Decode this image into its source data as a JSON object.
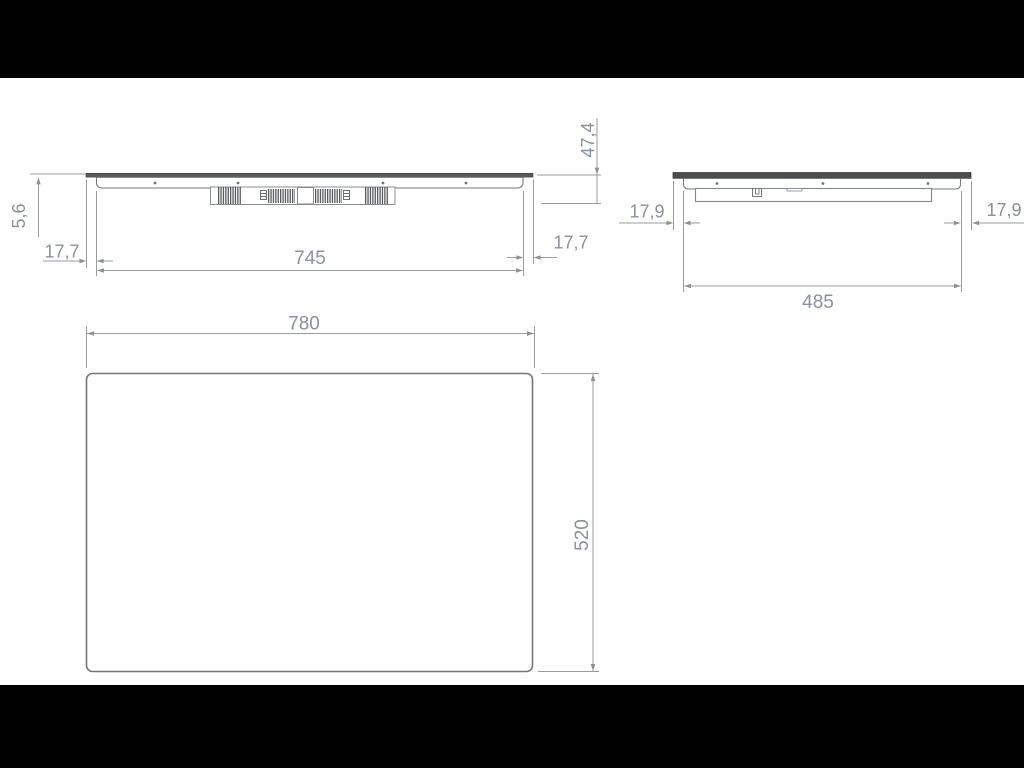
{
  "drawing_type": "appliance-dimension-drawing",
  "front_view": {
    "glass_protrusion": "5,6",
    "left_inset": "17,7",
    "body_width": "745",
    "right_inset": "17,7",
    "total_height": "47,4"
  },
  "side_view": {
    "left_inset": "17,9",
    "body_depth": "485",
    "right_inset": "17,9"
  },
  "top_view": {
    "glass_width": "780",
    "glass_depth": "520"
  },
  "colors": {
    "background": "#ffffff",
    "letterbox": "#000000",
    "object_line": "#77797d",
    "dimension_line": "#989ba0",
    "dimension_text": "#8b919a",
    "glass_dark": "#4b4e51"
  }
}
